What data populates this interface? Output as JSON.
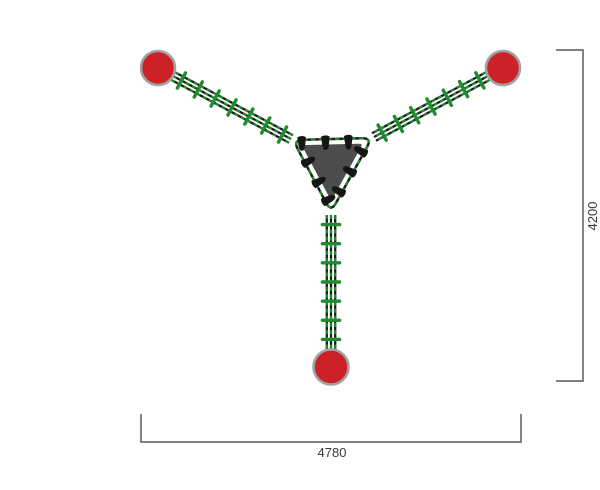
{
  "drawing": {
    "canvas": {
      "width": 600,
      "height": 458,
      "background": "#ffffff"
    },
    "colors": {
      "post_fill": "#cc2127",
      "post_ring": "#a2a2a2",
      "rope_green": "#1f8c2e",
      "rope_dark": "#1a1a1a",
      "platform_fill": "#4b4d4f",
      "platform_gap": "#ffffff",
      "connector_fill": "#161616",
      "dimension_line": "#6f6f6f",
      "dimension_text": "#3a3a3a"
    },
    "posts": [
      {
        "id": "post-top-left",
        "cx": 118,
        "cy": 52,
        "r": 17
      },
      {
        "id": "post-top-right",
        "cx": 463,
        "cy": 52,
        "r": 17
      },
      {
        "id": "post-bottom",
        "cx": 291,
        "cy": 351,
        "r": 17.5
      }
    ],
    "bridges": [
      {
        "id": "rope-bridge-upper-left",
        "x1": 133,
        "y1": 60,
        "x2": 251,
        "y2": 123,
        "rung_spacing": 19,
        "line_offsets": [
          -4.2,
          0,
          4.2
        ],
        "rung_half_length": 8.6
      },
      {
        "id": "rope-bridge-upper-right",
        "x1": 448,
        "y1": 60,
        "x2": 334,
        "y2": 121,
        "rung_spacing": 19,
        "line_offsets": [
          -4.2,
          0,
          4.2
        ],
        "rung_half_length": 8.6
      },
      {
        "id": "rope-bridge-bottom",
        "x1": 291,
        "y1": 199,
        "x2": 291,
        "y2": 333,
        "rung_spacing": 19,
        "line_offsets": [
          -4.2,
          0,
          4.2
        ],
        "rung_half_length": 8.6
      }
    ],
    "platform": {
      "id": "center-platform",
      "outline_vertices": [
        [
          253,
          124
        ],
        [
          332,
          122
        ],
        [
          291,
          196
        ]
      ],
      "inset_scale": 0.87,
      "corner_radius": 10,
      "inner_corner_radius": 9,
      "connectors": [
        {
          "side": 0,
          "t": 0.11
        },
        {
          "side": 0,
          "t": 0.41
        },
        {
          "side": 0,
          "t": 0.7
        },
        {
          "side": 1,
          "t": 0.2
        },
        {
          "side": 1,
          "t": 0.47
        },
        {
          "side": 1,
          "t": 0.74
        },
        {
          "side": 2,
          "t": 0.32
        },
        {
          "side": 2,
          "t": 0.6
        },
        {
          "side": 2,
          "t": 0.85
        }
      ]
    },
    "dimensions": {
      "height": {
        "id": "dimension-height",
        "label": "4200",
        "line_x": 543,
        "y1": 34,
        "y2": 365,
        "tick_length": 27,
        "label_x": 557,
        "label_y": 200,
        "font_size": 13
      },
      "width": {
        "id": "dimension-width",
        "label": "4780",
        "line_y": 426,
        "x1": 101,
        "x2": 481,
        "tick_length": 28,
        "label_x": 292,
        "label_y": 441,
        "font_size": 13
      }
    }
  }
}
